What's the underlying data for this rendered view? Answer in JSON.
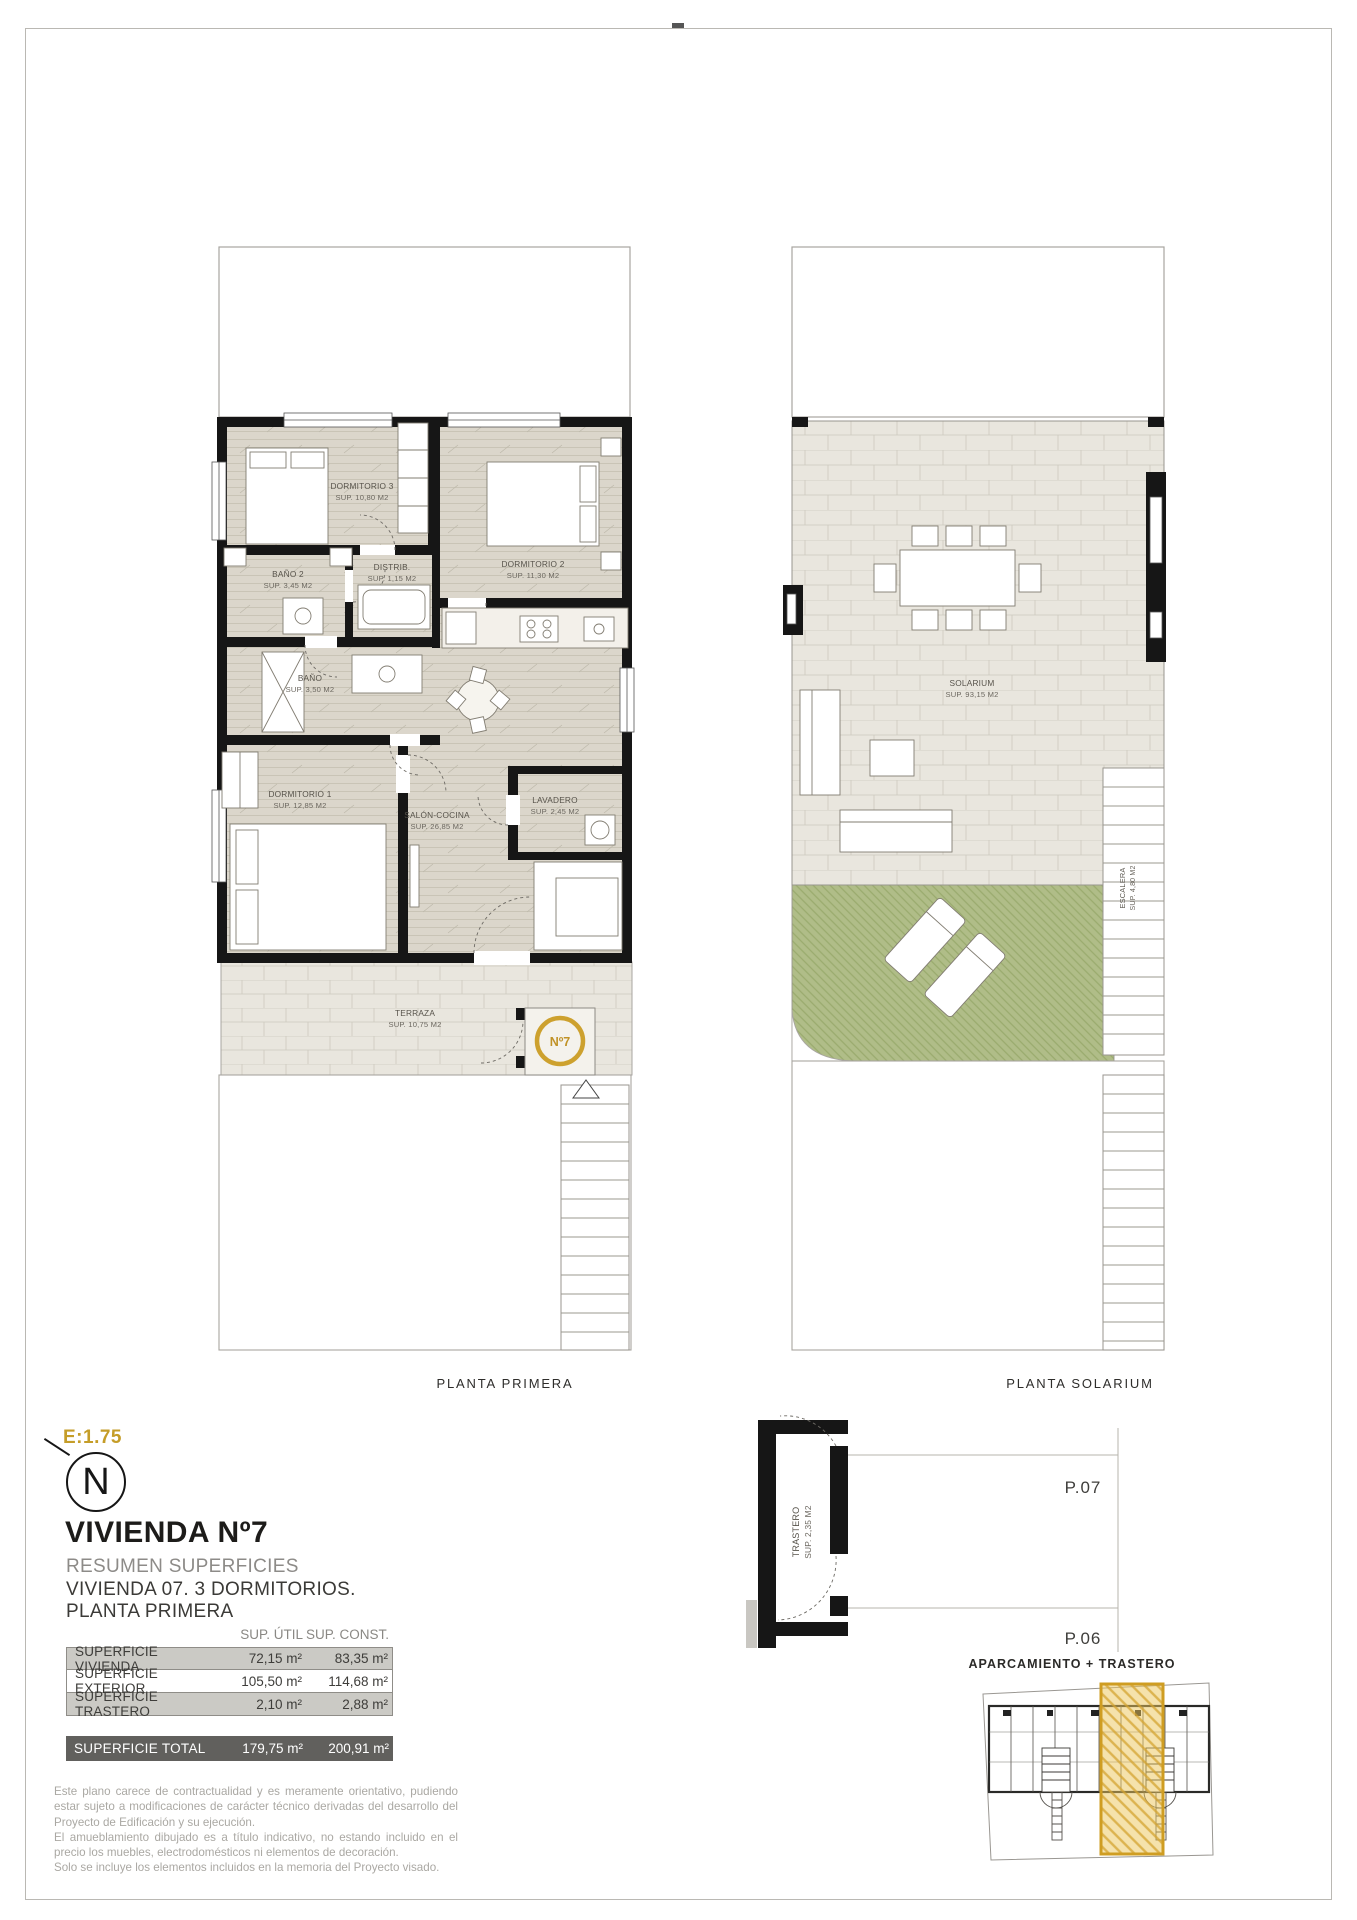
{
  "page": {
    "plan1_caption": "PLANTA PRIMERA",
    "plan2_caption": "PLANTA SOLARIUM",
    "parking_caption": "APARCAMIENTO + TRASTERO"
  },
  "plan1": {
    "rooms": [
      {
        "name": "DORMITORIO 3",
        "sup": "SUP. 10,80 M2"
      },
      {
        "name": "DORMITORIO 2",
        "sup": "SUP. 11,30 M2"
      },
      {
        "name": "BAÑO 2",
        "sup": "SUP. 3,45 M2"
      },
      {
        "name": "DISTRIB.",
        "sup": "SUP. 1,15 M2"
      },
      {
        "name": "BAÑO",
        "sup": "SUP. 3,50 M2"
      },
      {
        "name": "DORMITORIO 1",
        "sup": "SUP. 12,85 M2"
      },
      {
        "name": "SALÓN-COCINA",
        "sup": "SUP. 26,85 M2"
      },
      {
        "name": "LAVADERO",
        "sup": "SUP. 2,45 M2"
      },
      {
        "name": "TERRAZA",
        "sup": "SUP. 10,75 M2"
      }
    ],
    "badge": "Nº7"
  },
  "plan2": {
    "rooms": [
      {
        "name": "SOLARIUM",
        "sup": "SUP. 93,15 M2"
      },
      {
        "name": "ESCALERA",
        "sup": "SUP. 4,80 M2"
      }
    ]
  },
  "parking": {
    "trastero_name": "TRASTERO",
    "trastero_sup": "SUP. 2,35 M2",
    "spot_top": "P.07",
    "spot_bottom": "P.06"
  },
  "titleblock": {
    "scale": "E:1.75",
    "north_letter": "N",
    "title": "VIVIENDA Nº7",
    "line1": "RESUMEN SUPERFICIES",
    "line2": "VIVIENDA 07. 3 DORMITORIOS.",
    "line3": "PLANTA PRIMERA"
  },
  "surfaces_table": {
    "col_util": "SUP. ÚTIL",
    "col_const": "SUP. CONST.",
    "rows": [
      {
        "label": "SUPERFICIE VIVIENDA",
        "util": "72,15 m²",
        "const": "83,35 m²"
      },
      {
        "label": "SUPERFICIE EXTERIOR",
        "util": "105,50 m²",
        "const": "114,68 m²"
      },
      {
        "label": "SUPERFICIE TRASTERO",
        "util": "2,10 m²",
        "const": "2,88 m²"
      }
    ],
    "total": {
      "label": "SUPERFICIE TOTAL",
      "util": "179,75 m²",
      "const": "200,91 m²"
    }
  },
  "disclaimer": [
    "Este plano carece de contractualidad y es meramente orientativo, pudiendo estar sujeto a modificaciones de carácter técnico derivadas del desarrollo del Proyecto de Edificación y su ejecución.",
    "El amueblamiento dibujado es a título indicativo, no estando incluido en el precio los muebles, electrodomésticos ni elementos de decoración.",
    "Solo se incluye los elementos incluidos en la memoria del Proyecto visado."
  ],
  "colors": {
    "accent_gold": "#CDA12E",
    "wall": "#161616",
    "wood_floor": "#DBD6CB",
    "tile_floor": "#E9E6DE",
    "grass": "#B0BD88"
  }
}
